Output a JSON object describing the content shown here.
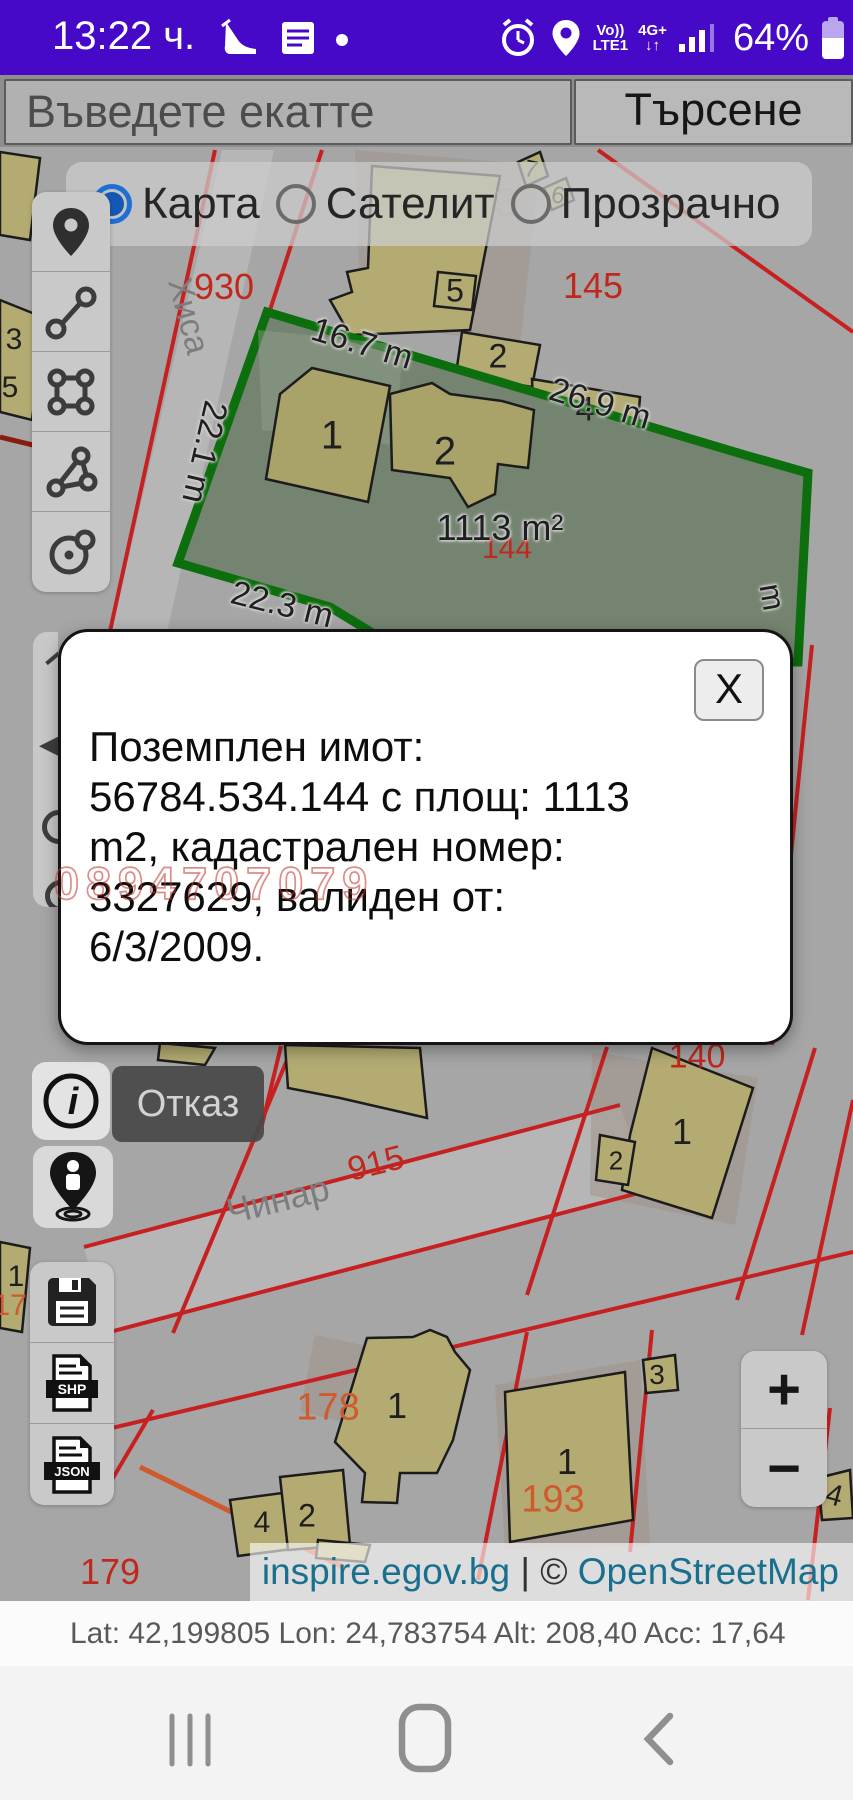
{
  "colors": {
    "statusbar_bg": "#4609c8",
    "accent_radio": "#1e6fd4",
    "parcel_green_border": "#0c6e0c",
    "parcel_green_fill": "#758471",
    "cadastre_red": "#c62021",
    "building_fill": "#b3ab72",
    "link_teal": "#19708e",
    "popup_bg": "#ffffff",
    "watermark_red": "#c43028"
  },
  "status_bar": {
    "time": "13:22 ч.",
    "battery": "64%",
    "net_line1": "Vo))",
    "net_line2": "LTE1",
    "net_4g": "4G+"
  },
  "search": {
    "placeholder": "Въведете екатте",
    "button": "Търсене"
  },
  "layers": {
    "options": [
      {
        "label": "Карта",
        "selected": true
      },
      {
        "label": "Сателит",
        "selected": false
      },
      {
        "label": "Прозрачно",
        "selected": false
      }
    ]
  },
  "toolbar": {
    "tools": [
      "locate",
      "measure-line",
      "measure-polygon",
      "measure-area",
      "measure-circle"
    ]
  },
  "popup": {
    "close": "X",
    "lines": [
      "Поземплен имот:",
      "56784.534.144 с площ: 1113",
      "m2, кадастрален номер:",
      "3327629, валиден от:",
      "6/3/2009."
    ],
    "full_text": "Поземплен имот: 56784.534.144 с площ: 1113 m2, кадастрален номер: 3327629, валиден от: 6/3/2009."
  },
  "watermark": "0894707079",
  "actions": {
    "cancel": "Отказ"
  },
  "export": {
    "shp": "SHP",
    "json": "JSON"
  },
  "zoom": {
    "in": "+",
    "out": "−"
  },
  "attribution": {
    "site": "inspire.egov.bg",
    "sep": "|",
    "copy": "©",
    "osm": "OpenStreetMap"
  },
  "status_line": "Lat: 42,199805 Lon: 24,783754 Alt: 208,40 Acc: 17,64",
  "map": {
    "labels": [
      {
        "t": "930",
        "x": 224,
        "y": 287,
        "s": 36,
        "c": "red"
      },
      {
        "t": "145",
        "x": 593,
        "y": 286,
        "s": 36,
        "c": "red"
      },
      {
        "t": "Хиса",
        "x": 188,
        "y": 316,
        "s": 34,
        "c": "street",
        "r": 75
      },
      {
        "t": "3",
        "x": 506,
        "y": 203,
        "s": 40,
        "c": "gray"
      },
      {
        "t": "7",
        "x": 531,
        "y": 170,
        "s": 24,
        "c": "",
        "r": 12
      },
      {
        "t": "6",
        "x": 558,
        "y": 196,
        "s": 24,
        "c": "",
        "r": 12
      },
      {
        "t": "5",
        "x": 455,
        "y": 291,
        "s": 32,
        "c": ""
      },
      {
        "t": "2",
        "x": 498,
        "y": 357,
        "s": 34,
        "c": ""
      },
      {
        "t": "4",
        "x": 585,
        "y": 410,
        "s": 34,
        "c": ""
      },
      {
        "t": "16.7 m",
        "x": 362,
        "y": 344,
        "s": 34,
        "c": "halo",
        "r": 17
      },
      {
        "t": "22.1 m",
        "x": 204,
        "y": 452,
        "s": 34,
        "c": "halo",
        "r": 103
      },
      {
        "t": "26.9 m",
        "x": 600,
        "y": 404,
        "s": 34,
        "c": "halo",
        "r": 17
      },
      {
        "t": "22.3 m",
        "x": 282,
        "y": 605,
        "s": 34,
        "c": "halo",
        "r": 14
      },
      {
        "t": "144",
        "x": 507,
        "y": 549,
        "s": 30,
        "c": "red"
      },
      {
        "t": "1113 m²",
        "x": 500,
        "y": 528,
        "s": 36,
        "c": "halo"
      },
      {
        "t": "1",
        "x": 332,
        "y": 436,
        "s": 40,
        "c": ""
      },
      {
        "t": "2",
        "x": 445,
        "y": 452,
        "s": 40,
        "c": ""
      },
      {
        "t": "3",
        "x": 14,
        "y": 340,
        "s": 30,
        "c": ""
      },
      {
        "t": "5",
        "x": 10,
        "y": 388,
        "s": 30,
        "c": ""
      },
      {
        "t": "m",
        "x": 772,
        "y": 597,
        "s": 32,
        "c": "halo",
        "r": 80
      },
      {
        "t": "140",
        "x": 697,
        "y": 1057,
        "s": 34,
        "c": "red"
      },
      {
        "t": "1",
        "x": 682,
        "y": 1132,
        "s": 36,
        "c": ""
      },
      {
        "t": "2",
        "x": 616,
        "y": 1161,
        "s": 26,
        "c": ""
      },
      {
        "t": "Чинар",
        "x": 278,
        "y": 1200,
        "s": 36,
        "c": "street",
        "r": -14
      },
      {
        "t": "915",
        "x": 376,
        "y": 1164,
        "s": 34,
        "c": "red",
        "r": -14
      },
      {
        "t": "1",
        "x": 16,
        "y": 1277,
        "s": 30,
        "c": ""
      },
      {
        "t": "17",
        "x": 10,
        "y": 1306,
        "s": 30,
        "c": "orange"
      },
      {
        "t": "178",
        "x": 328,
        "y": 1408,
        "s": 38,
        "c": "orange"
      },
      {
        "t": "1",
        "x": 397,
        "y": 1406,
        "s": 36,
        "c": ""
      },
      {
        "t": "4",
        "x": 262,
        "y": 1523,
        "s": 30,
        "c": ""
      },
      {
        "t": "2",
        "x": 307,
        "y": 1516,
        "s": 32,
        "c": ""
      },
      {
        "t": "1",
        "x": 567,
        "y": 1462,
        "s": 36,
        "c": ""
      },
      {
        "t": "193",
        "x": 553,
        "y": 1500,
        "s": 38,
        "c": "orange"
      },
      {
        "t": "3",
        "x": 657,
        "y": 1375,
        "s": 28,
        "c": ""
      },
      {
        "t": "4",
        "x": 834,
        "y": 1496,
        "s": 30,
        "c": "",
        "r": 15
      },
      {
        "t": "179",
        "x": 110,
        "y": 1572,
        "s": 36,
        "c": "red"
      }
    ]
  }
}
